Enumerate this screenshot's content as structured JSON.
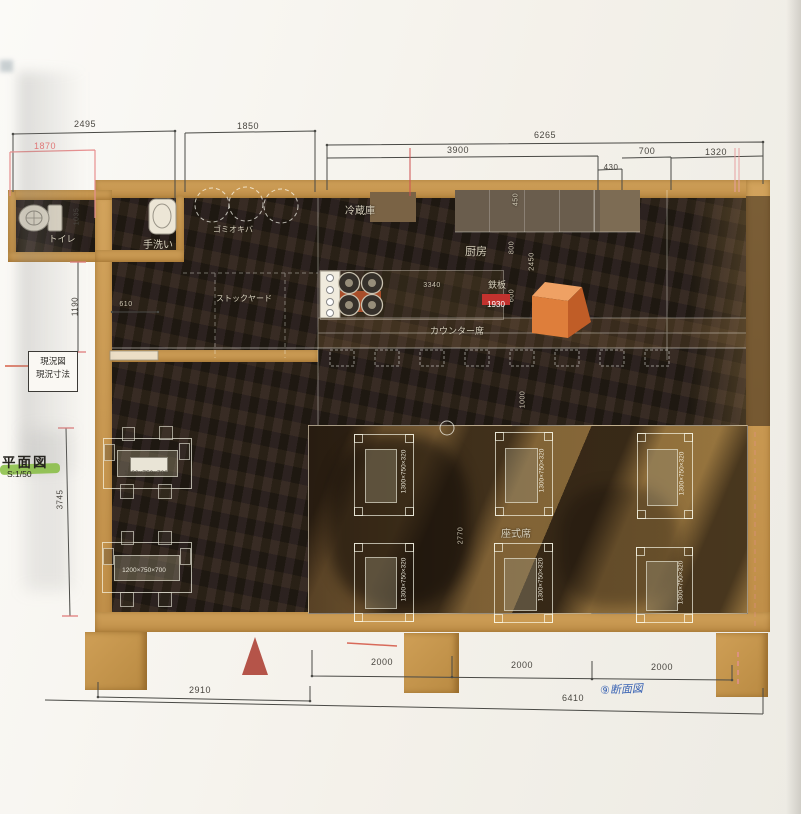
{
  "drawing": {
    "margin": {
      "legend_box": {
        "line1": "現況図",
        "line2": "現況寸法"
      },
      "title": "平面図",
      "scale": "S:1/50",
      "handwritten_note": "⑨断面図"
    },
    "colors": {
      "wall_tan": "#c8964e",
      "floor_dark": "#2b2318",
      "tatami": "#8a6a3a",
      "highlight_green": "#80ba36",
      "teppan_red": "#c2322e",
      "equipment_orange": "#de7e3b",
      "pink_dim": "#e07878",
      "ink_blue": "#3a64b4"
    },
    "dims": {
      "top": {
        "w2495": "2495",
        "w1870": "1870",
        "w1850": "1850",
        "w6265": "6265",
        "w3900": "3900",
        "w430": "430",
        "w700": "700",
        "w1320": "1320"
      },
      "left": {
        "h1035": "1035",
        "h1190": "1190",
        "h3745": "3745"
      },
      "inner": {
        "w610": "610",
        "w3340": "3340",
        "h450": "450",
        "h800": "800",
        "h2450": "2450",
        "h600": "600",
        "teppan_width": "1930",
        "h1000": "1000",
        "h2770": "2770"
      },
      "bottom": {
        "w2910": "2910",
        "w2000": [
          "2000",
          "2000",
          "2000"
        ],
        "w6410": "6410"
      }
    },
    "rooms": {
      "toilet": "トイレ",
      "handwash": "手洗い",
      "garbage": "ゴミオキバ",
      "stockyard": "ストックヤード",
      "fridge": "冷蔵庫",
      "kitchen": "厨房",
      "teppan": "鉄板",
      "counter_seats": "カウンター席",
      "zashiki_seats": "座式席"
    },
    "tables": {
      "high_table_label": "1200×750×700",
      "low_table_label": "1300×750×320"
    }
  }
}
